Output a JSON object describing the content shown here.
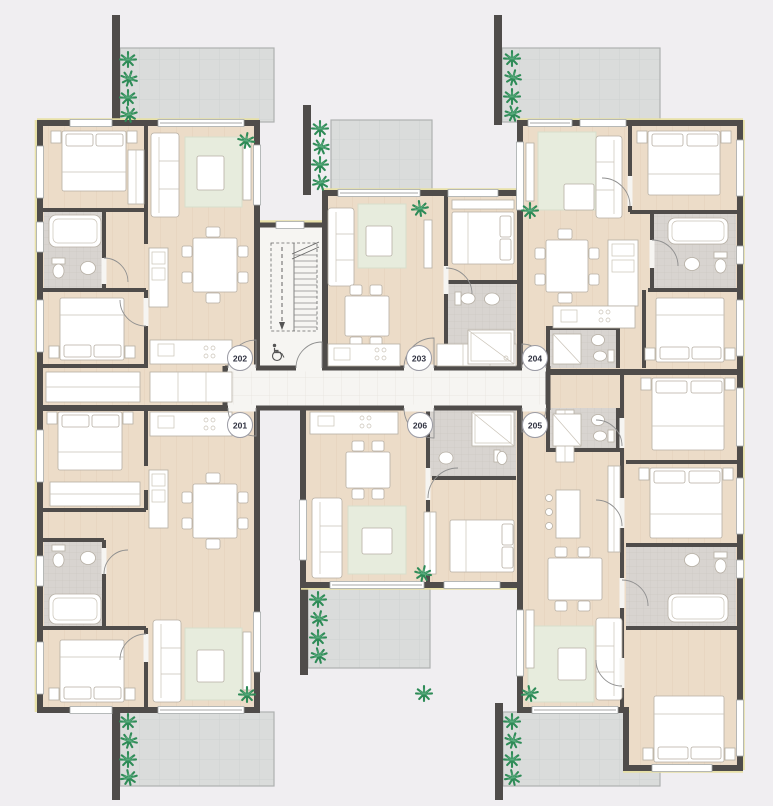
{
  "page": {
    "background_color": "#f0eef1"
  },
  "floor_plan": {
    "type": "residential-apartment-floor-plan",
    "units": [
      {
        "label": "201",
        "location": "lower-left"
      },
      {
        "label": "202",
        "location": "upper-left"
      },
      {
        "label": "203",
        "location": "upper-middle"
      },
      {
        "label": "204",
        "location": "upper-right"
      },
      {
        "label": "205",
        "location": "lower-right"
      },
      {
        "label": "206",
        "location": "lower-middle"
      }
    ],
    "circulation": {
      "corridor": "central-horizontal-corridor",
      "stairwell": "central-stair-with-accessibility-symbol"
    },
    "icons": {
      "accessibility": "wheelchair-icon",
      "vegetation": "palm-plant-icon"
    },
    "colors": {
      "wall": "#4f4c4a",
      "wood_floor": "#ecdcc8",
      "corridor_floor": "#f6f5f2",
      "bath_tile": "#d8d4d0",
      "rug": "#e7ecdd",
      "terrace": "#dadcdb",
      "plant_green": "#2e8b57",
      "insulation": "#e7dfa3",
      "badge_text": "#2f3140"
    }
  }
}
